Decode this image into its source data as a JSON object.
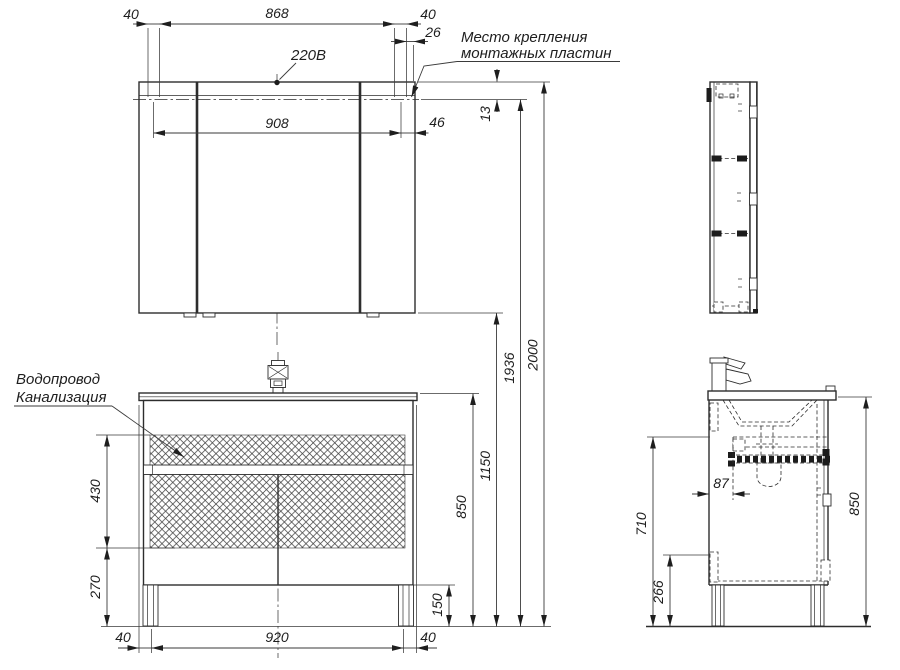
{
  "drawing": {
    "labels": {
      "power": "220В",
      "mount1": "Место крепления",
      "mount2": "монтажных пластин",
      "plumb1": "Водопровод",
      "plumb2": "Канализация"
    },
    "dims": {
      "m40l": "40",
      "m868": "868",
      "m40r": "40",
      "m26": "26",
      "m908": "908",
      "m46": "46",
      "m13": "13",
      "h850": "850",
      "h1150": "1150",
      "h1936": "1936",
      "h2000": "2000",
      "v430": "430",
      "v270": "270",
      "v150": "150",
      "b40l": "40",
      "b920": "920",
      "b40r": "40",
      "s87": "87",
      "s710": "710",
      "s266": "266",
      "s850": "850"
    },
    "colors": {
      "line": "#2d2d2d",
      "background": "#ffffff"
    }
  }
}
